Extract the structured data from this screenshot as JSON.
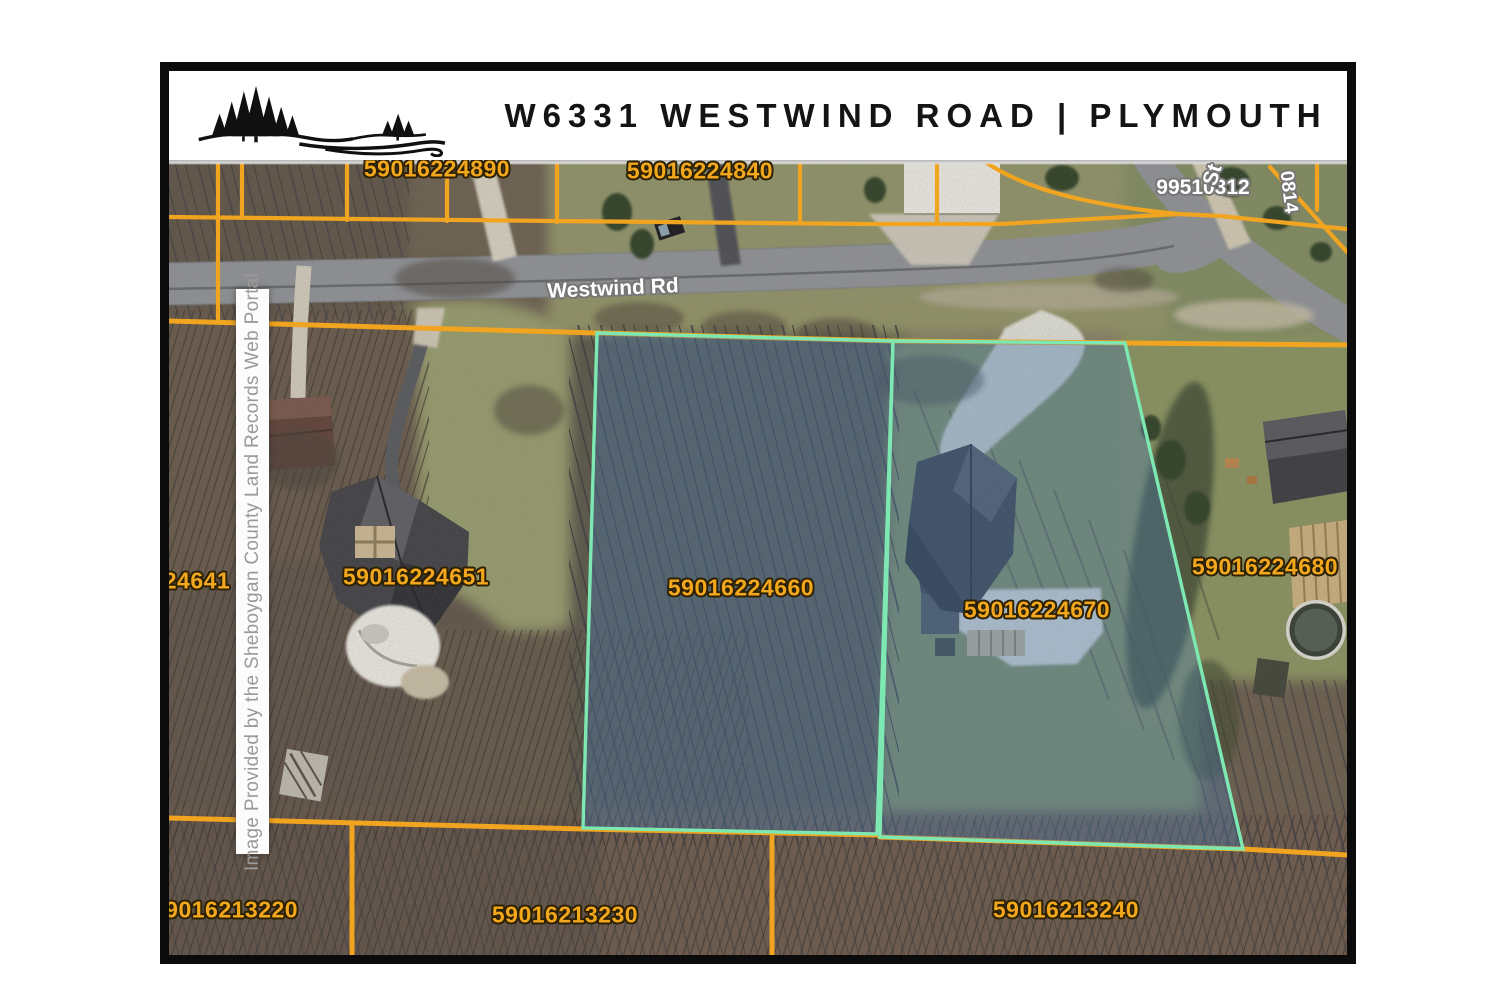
{
  "header": {
    "title": "W6331 WESTWIND ROAD | PLYMOUTH",
    "logo": "pine-tree-ridge-logo"
  },
  "map": {
    "credit": "Image Provided by the Sheboygan County Land Records Web Portal",
    "road_labels": {
      "main_road": "Westwind Rd",
      "cross_road_number": "99510312",
      "cross_road_name_fragment": "St",
      "corner_parcel_fragment": "0814"
    },
    "parcel_labels": {
      "top_left": "59016224890",
      "top_center": "59016224840",
      "west_edge": "24641",
      "west_neighbor": "59016224651",
      "subject_west": "59016224660",
      "subject_east": "59016224670",
      "east_neighbor": "59016224680",
      "south_west": "59016213220",
      "south_center": "59016213230",
      "south_east": "59016213240"
    },
    "highlighted_parcels": [
      "59016224660",
      "59016224670"
    ],
    "colors": {
      "parcel_line": "#f1a41f",
      "parcel_label_text": "#f2a71c",
      "highlight_outline": "#7ee8b2",
      "highlight_fill": "rgba(74,122,171,0.38)",
      "road_label_text": "#ffffff"
    }
  }
}
